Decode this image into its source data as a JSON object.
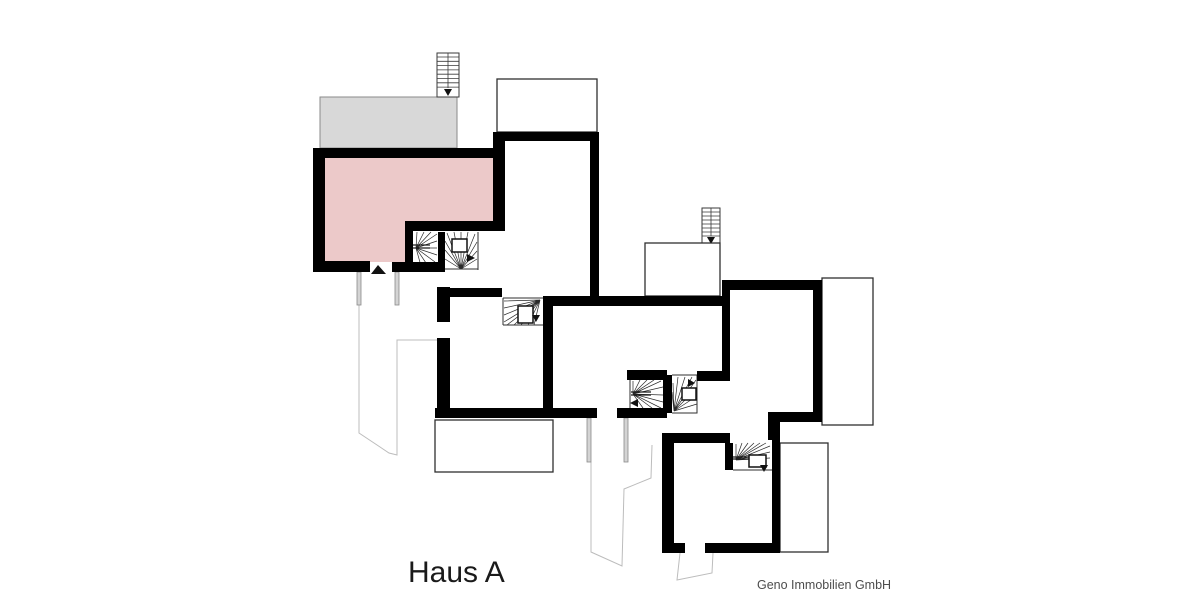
{
  "plan": {
    "title": "Haus A",
    "attribution": "Geno Immobilien GmbH",
    "colors": {
      "highlighted_unit": "#ecc9c9",
      "roof_terrace": "#d8d8d8",
      "wall": "#000000",
      "outline": "#2f2f2f",
      "lower_floor_outline": "#bcbcbc",
      "title_text": "#1a1a1a",
      "attribution_text": "#4d4d4d",
      "background": "#ffffff"
    },
    "icons": {
      "entrance_arrow": "triangle-up",
      "stair_direction_arrow": "small-triangle",
      "exterior_stair": "ladder-with-down-triangle"
    }
  }
}
